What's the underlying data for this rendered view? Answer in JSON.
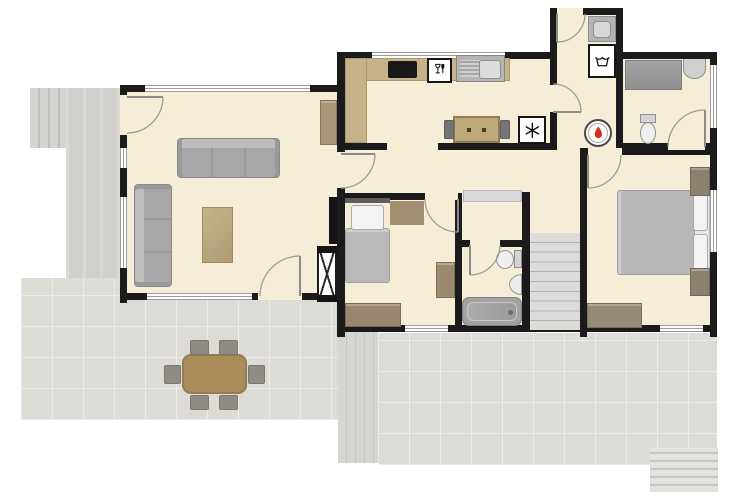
{
  "plan": {
    "canvas": {
      "w": 750,
      "h": 500
    },
    "colors": {
      "wall": "#1b1b1b",
      "floor": "#f6edd6",
      "tile": "#dddbd6",
      "grout": "#edebe7",
      "counter": "#c8b28b",
      "wood_table": "#ab8c5b",
      "sofa": "#a7a7a7",
      "blanket": "#b9b9b9",
      "flame": "#d3301c",
      "appliance_border": "#161616"
    },
    "layers": {
      "outdoor": [
        {
          "n": "garden-steps-top-left",
          "t": "steps-v",
          "x": 30,
          "y": 88,
          "w": 38,
          "h": 60
        },
        {
          "n": "concrete-path",
          "t": "path",
          "x": 66,
          "y": 88,
          "w": 57,
          "h": 200
        },
        {
          "n": "patio-left",
          "t": "tile",
          "x": 21,
          "y": 278,
          "w": 324,
          "h": 142
        },
        {
          "n": "wooden-deck",
          "t": "deck",
          "x": 338,
          "y": 300,
          "w": 40,
          "h": 163
        },
        {
          "n": "patio-back",
          "t": "tile",
          "x": 378,
          "y": 333,
          "w": 339,
          "h": 132
        },
        {
          "n": "garden-steps-bottom-right",
          "t": "steps-h",
          "x": 650,
          "y": 448,
          "w": 68,
          "h": 44
        }
      ],
      "floors": [
        {
          "n": "floor-living-room",
          "t": "floor",
          "x": 123,
          "y": 85,
          "w": 222,
          "h": 215
        },
        {
          "n": "floor-kitchen-and-wc",
          "t": "floor",
          "x": 337,
          "y": 52,
          "w": 380,
          "h": 98
        },
        {
          "n": "floor-utility-room",
          "t": "floor",
          "x": 550,
          "y": 8,
          "w": 72,
          "h": 44
        },
        {
          "n": "floor-bedrooms-hall-bath",
          "t": "floor",
          "x": 337,
          "y": 150,
          "w": 380,
          "h": 182
        }
      ],
      "walls": [
        {
          "n": "wall-living-top",
          "t": "wall",
          "x": 120,
          "y": 85,
          "w": 225,
          "h": 7
        },
        {
          "n": "wall-living-left",
          "t": "wall",
          "x": 120,
          "y": 85,
          "w": 7,
          "h": 218
        },
        {
          "n": "wall-living-bottom",
          "t": "wall",
          "x": 120,
          "y": 293,
          "w": 225,
          "h": 7
        },
        {
          "n": "wall-east-spine",
          "t": "wall",
          "x": 337,
          "y": 85,
          "w": 8,
          "h": 252
        },
        {
          "n": "wall-kitchen-west",
          "t": "wall",
          "x": 337,
          "y": 52,
          "w": 8,
          "h": 33
        },
        {
          "n": "wall-north-west",
          "t": "wall",
          "x": 337,
          "y": 52,
          "w": 213,
          "h": 7
        },
        {
          "n": "wall-north-east",
          "t": "wall",
          "x": 622,
          "y": 52,
          "w": 95,
          "h": 7
        },
        {
          "n": "wall-right",
          "t": "wall",
          "x": 710,
          "y": 52,
          "w": 7,
          "h": 285
        },
        {
          "n": "wall-utility-top",
          "t": "wall",
          "x": 550,
          "y": 8,
          "w": 73,
          "h": 7
        },
        {
          "n": "wall-utility-left",
          "t": "wall",
          "x": 550,
          "y": 8,
          "w": 7,
          "h": 142
        },
        {
          "n": "wall-utility-right",
          "t": "wall",
          "x": 616,
          "y": 8,
          "w": 7,
          "h": 142
        },
        {
          "n": "wall-kitchen-south",
          "t": "wall",
          "x": 345,
          "y": 143,
          "w": 212,
          "h": 7
        },
        {
          "n": "wall-wc-south",
          "t": "wall",
          "x": 623,
          "y": 143,
          "w": 94,
          "h": 7
        },
        {
          "n": "wall-master-top",
          "t": "wall",
          "x": 580,
          "y": 148,
          "w": 137,
          "h": 7
        },
        {
          "n": "wall-master-west",
          "t": "wall",
          "x": 580,
          "y": 148,
          "w": 7,
          "h": 189
        },
        {
          "n": "wall-bedroom2-top",
          "t": "wall",
          "x": 337,
          "y": 193,
          "w": 125,
          "h": 7
        },
        {
          "n": "wall-bedroom2-east",
          "t": "wall",
          "x": 455,
          "y": 193,
          "w": 7,
          "h": 139
        },
        {
          "n": "wall-bath-top",
          "t": "wall",
          "x": 462,
          "y": 240,
          "w": 68,
          "h": 7
        },
        {
          "n": "wall-bath-east",
          "t": "wall",
          "x": 522,
          "y": 192,
          "w": 8,
          "h": 140
        },
        {
          "n": "wall-south",
          "t": "wall",
          "x": 337,
          "y": 325,
          "w": 380,
          "h": 7
        }
      ],
      "openings": [
        {
          "n": "window-living-top",
          "t": "window-h",
          "x": 145,
          "y": 85,
          "w": 165,
          "h": 7
        },
        {
          "n": "window-living-left-1",
          "t": "window-v",
          "x": 120,
          "y": 148,
          "w": 7,
          "h": 20
        },
        {
          "n": "window-living-left-2",
          "t": "window-v",
          "x": 120,
          "y": 197,
          "w": 7,
          "h": 71
        },
        {
          "n": "window-living-bottom",
          "t": "window-h",
          "x": 147,
          "y": 293,
          "w": 105,
          "h": 7
        },
        {
          "n": "doorway-living-bottom",
          "t": "gap",
          "x": 258,
          "y": 293,
          "w": 44,
          "h": 7
        },
        {
          "n": "doorway-entry",
          "t": "gap",
          "x": 120,
          "y": 95,
          "w": 7,
          "h": 40
        },
        {
          "n": "doorway-living-hall",
          "t": "gap",
          "x": 337,
          "y": 152,
          "w": 8,
          "h": 36
        },
        {
          "n": "window-kitchen-top",
          "t": "window-h",
          "x": 372,
          "y": 52,
          "w": 133,
          "h": 7
        },
        {
          "n": "doorway-utility-exterior",
          "t": "gap",
          "x": 557,
          "y": 8,
          "w": 26,
          "h": 7
        },
        {
          "n": "doorway-kitchen-utility",
          "t": "gap",
          "x": 550,
          "y": 85,
          "w": 7,
          "h": 27
        },
        {
          "n": "opening-kitchen-hall",
          "t": "gap",
          "x": 387,
          "y": 143,
          "w": 51,
          "h": 7
        },
        {
          "n": "doorway-wc",
          "t": "gap",
          "x": 668,
          "y": 143,
          "w": 37,
          "h": 7
        },
        {
          "n": "doorway-master-bedroom",
          "t": "gap",
          "x": 588,
          "y": 148,
          "w": 34,
          "h": 7
        },
        {
          "n": "doorway-bedroom2",
          "t": "gap",
          "x": 425,
          "y": 193,
          "w": 33,
          "h": 7
        },
        {
          "n": "doorway-bathroom",
          "t": "gap",
          "x": 470,
          "y": 240,
          "w": 30,
          "h": 7
        },
        {
          "n": "window-wc-right",
          "t": "window-v",
          "x": 710,
          "y": 65,
          "w": 7,
          "h": 63
        },
        {
          "n": "window-master-right",
          "t": "window-v",
          "x": 710,
          "y": 190,
          "w": 7,
          "h": 62
        },
        {
          "n": "window-bedroom2-south",
          "t": "window-h",
          "x": 405,
          "y": 325,
          "w": 43,
          "h": 7
        },
        {
          "n": "window-master-south",
          "t": "window-h",
          "x": 660,
          "y": 325,
          "w": 43,
          "h": 7
        }
      ],
      "furniture": [
        {
          "n": "sofa-three-seat",
          "t": "sofa-h",
          "x": 177,
          "y": 138,
          "w": 103,
          "h": 40
        },
        {
          "n": "sofa-chaise",
          "t": "sofa-v",
          "x": 134,
          "y": 184,
          "w": 38,
          "h": 103
        },
        {
          "n": "coffee-table",
          "t": "ctable",
          "x": 202,
          "y": 207,
          "w": 31,
          "h": 56
        },
        {
          "n": "living-cabinet",
          "t": "cab",
          "x": 320,
          "y": 100,
          "w": 17,
          "h": 45,
          "c": "#a99577"
        },
        {
          "n": "wall-tv",
          "t": "tv",
          "x": 329,
          "y": 197,
          "w": 8,
          "h": 47
        },
        {
          "n": "tv-unit",
          "t": "xcab",
          "x": 317,
          "y": 246,
          "w": 20,
          "h": 56
        },
        {
          "n": "kitchen-counter-top",
          "t": "counter",
          "x": 345,
          "y": 58,
          "w": 165,
          "h": 23
        },
        {
          "n": "kitchen-counter-left",
          "t": "counter",
          "x": 345,
          "y": 58,
          "w": 22,
          "h": 85
        },
        {
          "n": "cooktop",
          "t": "cooktop",
          "x": 388,
          "y": 61,
          "w": 29,
          "h": 17
        },
        {
          "n": "kitchen-table",
          "t": "table",
          "x": 453,
          "y": 116,
          "w": 47,
          "h": 27
        },
        {
          "n": "kitchen-chair-left",
          "t": "chair",
          "x": 444,
          "y": 120,
          "w": 10,
          "h": 19
        },
        {
          "n": "kitchen-chair-right",
          "t": "chair",
          "x": 500,
          "y": 120,
          "w": 10,
          "h": 19
        },
        {
          "n": "hall-sideboard",
          "t": "sideboard",
          "x": 463,
          "y": 190,
          "w": 59,
          "h": 12
        },
        {
          "n": "staircase",
          "t": "stairs",
          "x": 530,
          "y": 233,
          "w": 50,
          "h": 97
        },
        {
          "n": "wc-countertop",
          "t": "wcounter",
          "x": 625,
          "y": 60,
          "w": 57,
          "h": 30
        },
        {
          "n": "wc-washbasin",
          "t": "basin-top",
          "x": 683,
          "y": 59,
          "w": 23,
          "h": 20
        },
        {
          "n": "bedroom2-headboard",
          "t": "headboard",
          "x": 345,
          "y": 198,
          "w": 45,
          "h": 5
        },
        {
          "n": "bedroom2-blanket",
          "t": "blanket-t",
          "x": 345,
          "y": 228,
          "w": 45,
          "h": 55
        },
        {
          "n": "bedroom2-pillow",
          "t": "pillow",
          "x": 351,
          "y": 205,
          "w": 33,
          "h": 25
        },
        {
          "n": "bedroom2-rug",
          "t": "mat",
          "x": 390,
          "y": 201,
          "w": 34,
          "h": 24,
          "c": "#a39072"
        },
        {
          "n": "bedroom2-cabinet",
          "t": "cab",
          "x": 436,
          "y": 262,
          "w": 19,
          "h": 36,
          "c": "#9c8a6e"
        },
        {
          "n": "bedroom2-dresser",
          "t": "cab",
          "x": 345,
          "y": 303,
          "w": 56,
          "h": 24,
          "c": "#99886d"
        },
        {
          "n": "master-bedframe",
          "t": "bedframe",
          "x": 692,
          "y": 189,
          "w": 18,
          "h": 87
        },
        {
          "n": "master-blanket",
          "t": "blanket-l",
          "x": 617,
          "y": 190,
          "w": 78,
          "h": 85
        },
        {
          "n": "master-pillow-top",
          "t": "pillow",
          "x": 693,
          "y": 194,
          "w": 15,
          "h": 37
        },
        {
          "n": "master-pillow-bottom",
          "t": "pillow",
          "x": 693,
          "y": 234,
          "w": 15,
          "h": 37
        },
        {
          "n": "nightstand-north",
          "t": "cab",
          "x": 690,
          "y": 167,
          "w": 20,
          "h": 29,
          "c": "#8c8071"
        },
        {
          "n": "nightstand-south",
          "t": "cab",
          "x": 690,
          "y": 268,
          "w": 20,
          "h": 28,
          "c": "#8c8071"
        },
        {
          "n": "master-dresser",
          "t": "cab",
          "x": 587,
          "y": 303,
          "w": 55,
          "h": 25,
          "c": "#958a76"
        },
        {
          "n": "patio-dining-table",
          "t": "dtable",
          "x": 182,
          "y": 354,
          "w": 65,
          "h": 40
        },
        {
          "n": "patio-chair-1",
          "t": "dchair",
          "x": 190,
          "y": 340,
          "w": 19,
          "h": 15
        },
        {
          "n": "patio-chair-2",
          "t": "dchair",
          "x": 219,
          "y": 340,
          "w": 19,
          "h": 15
        },
        {
          "n": "patio-chair-3",
          "t": "dchair",
          "x": 190,
          "y": 395,
          "w": 19,
          "h": 15
        },
        {
          "n": "patio-chair-4",
          "t": "dchair",
          "x": 219,
          "y": 395,
          "w": 19,
          "h": 15
        },
        {
          "n": "patio-chair-5",
          "t": "dchair",
          "x": 164,
          "y": 365,
          "w": 17,
          "h": 19
        },
        {
          "n": "patio-chair-6",
          "t": "dchair",
          "x": 248,
          "y": 365,
          "w": 17,
          "h": 19
        }
      ],
      "fixtures": [
        {
          "n": "kitchen-sink",
          "t": "sink-unit",
          "x": 456,
          "y": 55,
          "w": 49,
          "h": 27
        },
        {
          "n": "dishwasher",
          "t": "appliance",
          "x": 427,
          "y": 58,
          "w": 25,
          "h": 25,
          "i": "icon-wineglass-fork"
        },
        {
          "n": "freezer",
          "t": "appliance",
          "x": 518,
          "y": 116,
          "w": 28,
          "h": 28,
          "i": "icon-snowflake"
        },
        {
          "n": "washing-machine",
          "t": "appliance",
          "x": 588,
          "y": 44,
          "w": 28,
          "h": 34,
          "i": "icon-laundry-tub"
        },
        {
          "n": "utility-sink",
          "t": "usink",
          "x": 588,
          "y": 16,
          "w": 28,
          "h": 26
        },
        {
          "n": "boiler",
          "t": "boiler",
          "x": 584,
          "y": 119,
          "w": 28,
          "h": 28,
          "i": "icon-flame"
        },
        {
          "n": "wc-toilet-tank",
          "t": "ttank",
          "x": 640,
          "y": 114,
          "w": 16,
          "h": 9
        },
        {
          "n": "wc-toilet-bowl",
          "t": "tbowl",
          "x": 640,
          "y": 122,
          "w": 16,
          "h": 22
        },
        {
          "n": "bath-toilet-tank",
          "t": "ttank",
          "x": 514,
          "y": 250,
          "w": 8,
          "h": 18
        },
        {
          "n": "bath-toilet-bowl",
          "t": "tbowl",
          "x": 496,
          "y": 250,
          "w": 18,
          "h": 19
        },
        {
          "n": "bath-washbasin",
          "t": "basin-r",
          "x": 509,
          "y": 274,
          "w": 13,
          "h": 21
        },
        {
          "n": "bathtub",
          "t": "tub",
          "x": 462,
          "y": 297,
          "w": 60,
          "h": 29
        }
      ]
    },
    "doors": [
      {
        "n": "door-entry",
        "leaf": "M127 97 h36",
        "arc": "M163 97 A36 36 0 0 1 127 133"
      },
      {
        "n": "door-living-bottom",
        "leaf": "M300 296 v-40",
        "arc": "M300 256 A40 40 0 0 0 260 296"
      },
      {
        "n": "door-living-hall",
        "leaf": "M341 154 h34",
        "arc": "M375 154 A34 34 0 0 1 341 188"
      },
      {
        "n": "door-kitchen-utility",
        "leaf": "M553 112 h28",
        "arc": "M581 112 A28 28 0 0 0 553 84"
      },
      {
        "n": "door-utility-exterior",
        "leaf": "M557 14 v28",
        "arc": "M557 42 A28 28 0 0 0 585 14"
      },
      {
        "n": "door-wc",
        "leaf": "M705 147 v-37",
        "arc": "M705 110 A37 37 0 0 0 668 147"
      },
      {
        "n": "door-master-bedroom",
        "leaf": "M588 155 v33",
        "arc": "M588 188 A33 33 0 0 0 621 155"
      },
      {
        "n": "door-bedroom2",
        "leaf": "M458 199 v33",
        "arc": "M458 232 A33 33 0 0 1 425 199"
      },
      {
        "n": "door-bathroom",
        "leaf": "M470 245 v30",
        "arc": "M470 275 A30 30 0 0 0 500 245"
      }
    ]
  }
}
